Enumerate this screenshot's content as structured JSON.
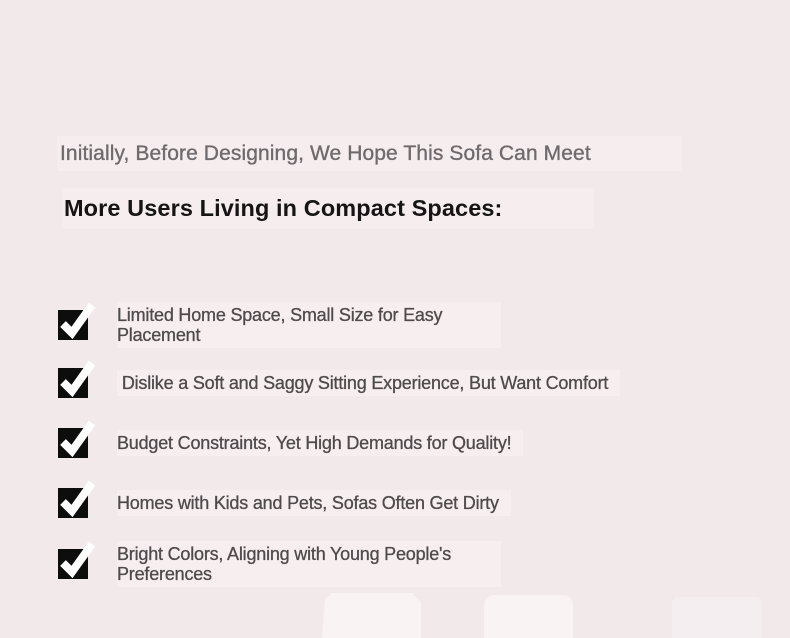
{
  "page": {
    "background_color": "#f2e9eb",
    "highlight_band_color": "#f6edef"
  },
  "title": {
    "line1": "Initially, Before Designing, We Hope This Sofa Can Meet",
    "line2": "More Users Living in Compact Spaces:"
  },
  "checklist": {
    "checkbox_icon": "checked-checkbox-icon",
    "checkbox_color": "#0e0d0d",
    "checkmark_color": "#ffffff",
    "items": [
      {
        "label": "Limited Home Space, Small Size for Easy Placement"
      },
      {
        "label": " Dislike a Soft and Saggy Sitting Experience, But Want Comfort"
      },
      {
        "label": "Budget Constraints, Yet High Demands for Quality!"
      },
      {
        "label": "Homes with Kids and Pets, Sofas Often Get Dirty"
      },
      {
        "label": "Bright Colors, Aligning with Young People's Preferences"
      }
    ]
  },
  "colors": {
    "title_muted_text": "#6e6a6d",
    "title_strong_text": "#161415",
    "item_text": "#4f4b4d",
    "bottom_card": "#f9f3f4"
  }
}
